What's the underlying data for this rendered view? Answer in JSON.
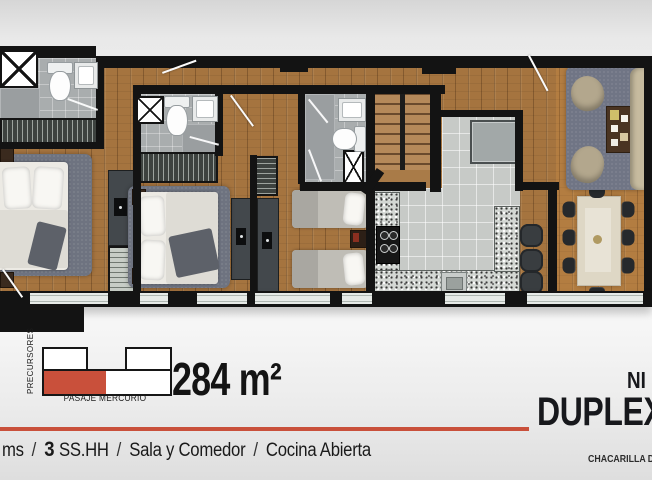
{
  "meta": {
    "colors": {
      "accent": "#c9503b",
      "wall": "#131313",
      "wood": "#a5743f"
    }
  },
  "locator": {
    "side_street": "PRECURSORES",
    "bottom_street": "PASAJE MERCURIO",
    "area": "284 m²"
  },
  "title_block": {
    "level": "NI",
    "unit": "DUPLEX.8",
    "address": "CHACARILLA DEL"
  },
  "features": {
    "fragment": "ms",
    "sep": "/",
    "bath_count": "3",
    "bath_label": "SS.HH",
    "living": "Sala y Comedor",
    "kitchen": "Cocina Abierta"
  }
}
